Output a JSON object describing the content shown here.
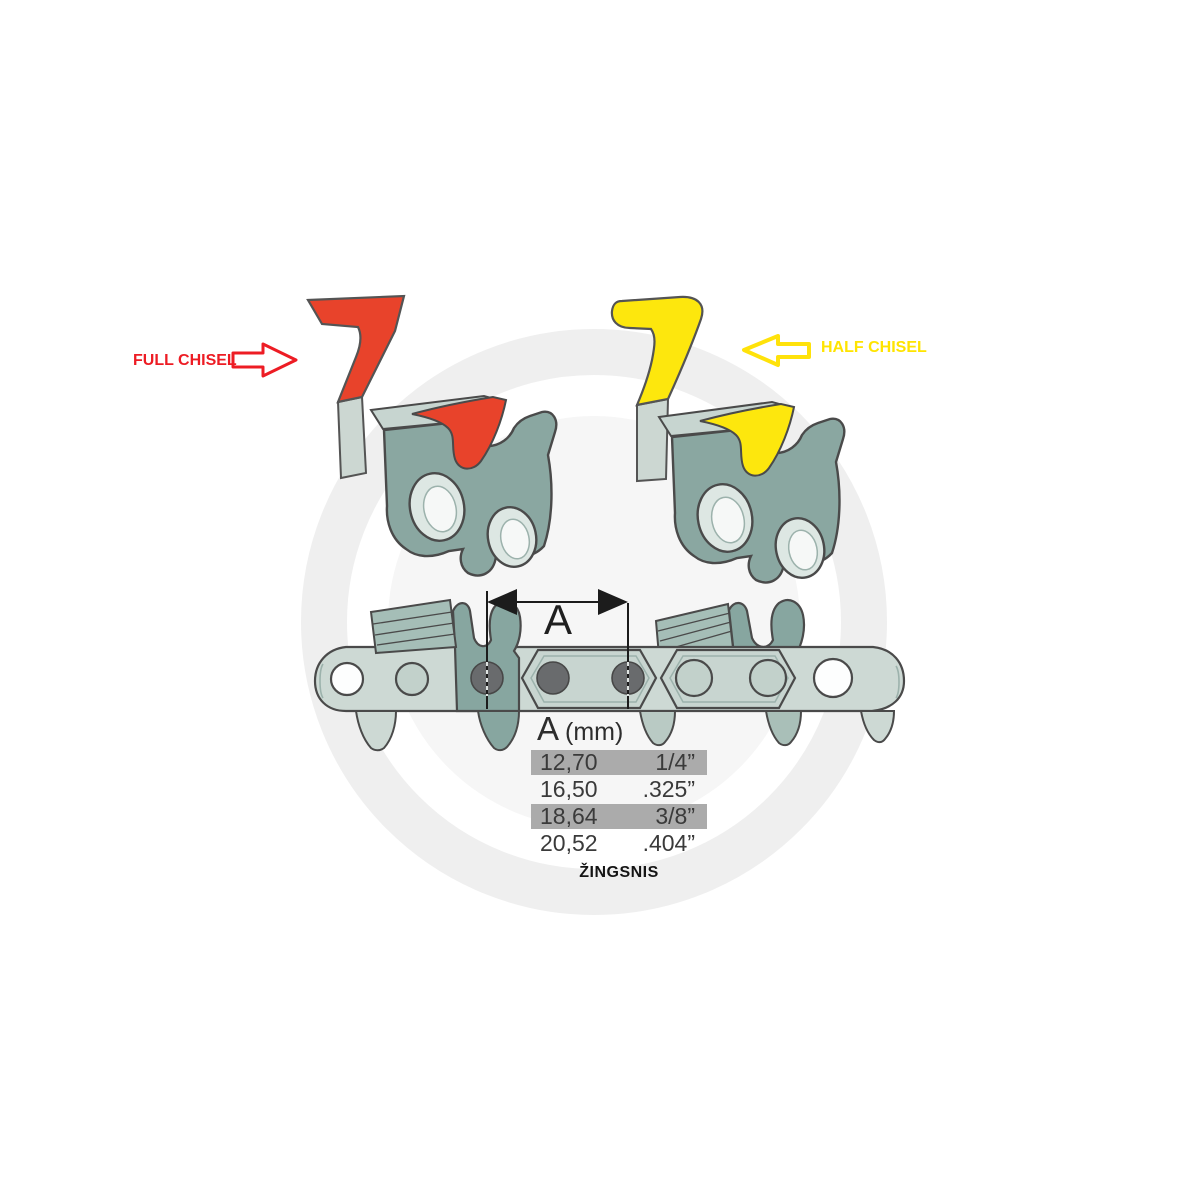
{
  "page": {
    "background": "#ffffff",
    "description": "Chainsaw chain pitch diagram with full and half chisel cutter profiles"
  },
  "watermark": {
    "logo": "APB",
    "subtitle": "AGRO PARTS BALTIJA",
    "color": "#b7b7b7"
  },
  "labels": {
    "full_chisel": "FULL CHISEL",
    "half_chisel": "HALF CHISEL",
    "dimension": "A",
    "pitch_caption": "ŽINGSNIS"
  },
  "table": {
    "header": {
      "symbol": "A",
      "unit": "(mm)"
    },
    "rows": [
      {
        "mm": "12,70",
        "inch": "1/4”",
        "highlighted": true
      },
      {
        "mm": "16,50",
        "inch": ".325”",
        "highlighted": false
      },
      {
        "mm": "18,64",
        "inch": "3/8”",
        "highlighted": true
      },
      {
        "mm": "20,52",
        "inch": ".404”",
        "highlighted": false
      }
    ],
    "highlight_color": "#ababab"
  },
  "colors": {
    "full_chisel_accent": "#ed1c24",
    "full_chisel_fill": "#e8432b",
    "half_chisel_accent": "#ffe400",
    "half_chisel_fill": "#fde70d",
    "link_body_teal": "#87a6a0",
    "link_plate_light": "#c7d5d0",
    "chain_band": "#cdd9d4",
    "rivet_gray": "#696b6d",
    "outline": "#4a4a4a",
    "dimension_line": "#1c1c1c"
  },
  "icons": {
    "right_block_arrow": "arrow pointing right (red outline)",
    "left_block_arrow": "arrow pointing left (yellow outline)",
    "dimension_arrows": "double-headed pitch dimension arrow"
  }
}
